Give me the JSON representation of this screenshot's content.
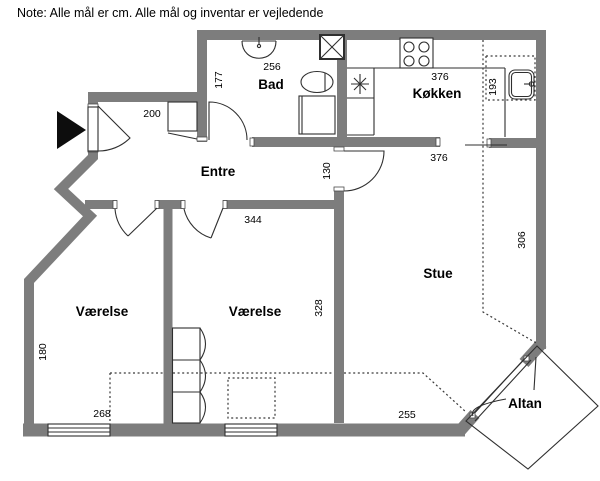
{
  "note": "Note: Alle mål er cm. Alle mål og inventar er vejledende",
  "rooms": {
    "bad": "Bad",
    "koekken": "Køkken",
    "entre": "Entre",
    "stue": "Stue",
    "vaerelse_left": "Værelse",
    "vaerelse_mid": "Værelse",
    "altan": "Altan"
  },
  "dimensions": {
    "bad_width": "256",
    "bad_depth": "177",
    "koekken_width": "376",
    "niche_depth": "193",
    "entre_width": "200",
    "passage_height": "130",
    "vaerelse_mid_width": "344",
    "stue_width": "376",
    "stue_depth": "306",
    "vaerelse_mid_depth": "328",
    "vaerelse_left_depth": "180",
    "vaerelse_left_width": "268",
    "stue_bottom_width": "255"
  },
  "colors": {
    "wall": "#7d7d7d",
    "line": "#2f2f2f",
    "bg": "#ffffff",
    "text": "#000000"
  }
}
